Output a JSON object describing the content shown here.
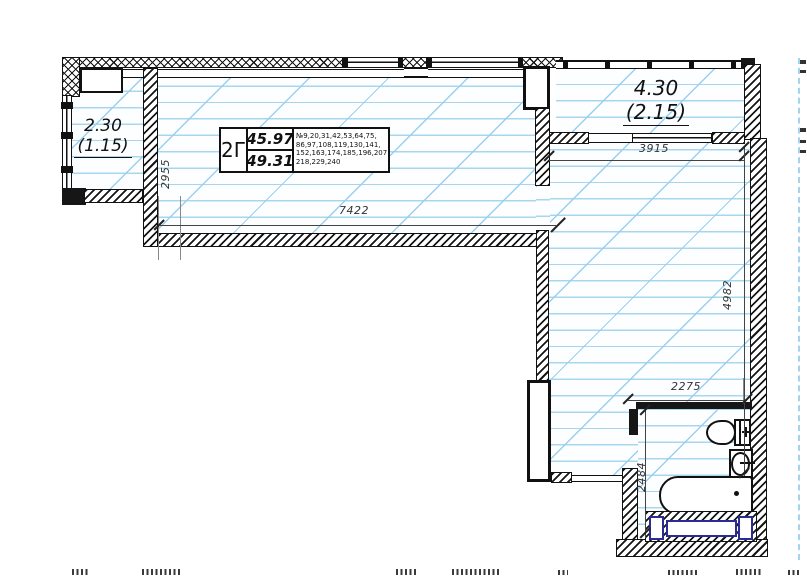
{
  "plan": {
    "title_box": {
      "type": "2Г",
      "area_top": "45.97",
      "area_bottom": "49.31",
      "apt_line1": "№9,20,31,42,53,64,75,",
      "apt_line2": "86,97,108,119,130,141,",
      "apt_line3": "152,163,174,185,196,207",
      "apt_line4": "218,229,240"
    },
    "balcony_left": {
      "area": "2.30",
      "coeff": "(1.15)"
    },
    "balcony_right": {
      "area": "4.30",
      "coeff": "(2.15)"
    },
    "dimensions": {
      "main_room_width": "7422",
      "left_balcony_height": "2955",
      "right_balcony_width": "3915",
      "right_room_height": "4982",
      "bathroom_width": "2275",
      "bathroom_height": "2484"
    },
    "colors": {
      "floor_line": "#a9d6ef",
      "wall": "#161616",
      "plumbing_blue": "#2b2b96"
    }
  }
}
